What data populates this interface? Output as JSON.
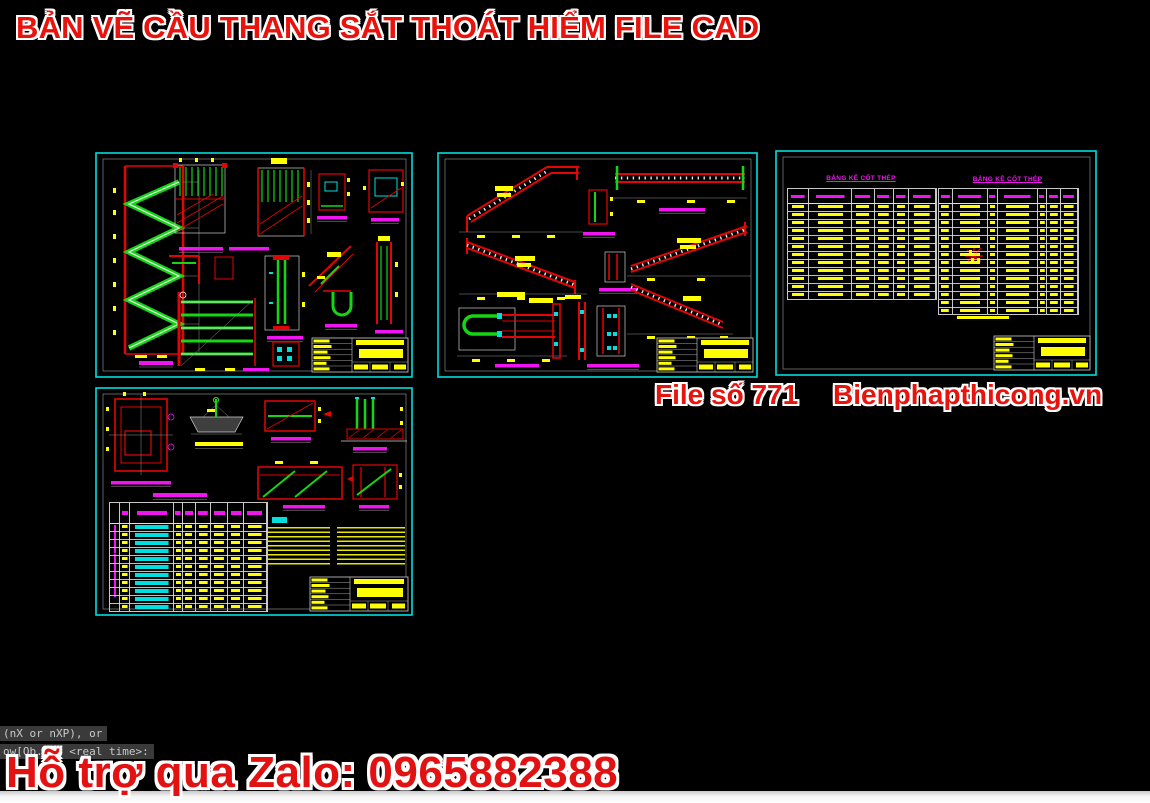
{
  "header": {
    "title": "BẢN VẼ CẦU THANG SẮT THOÁT HIỂM FILE CAD"
  },
  "watermark": {
    "file_label": "File số 771",
    "website": "Bienphapthicong.vn"
  },
  "support_banner": {
    "text": "Hỗ trợ qua Zalo: 0965882388"
  },
  "command_line": {
    "line1": "(nX or nXP), or",
    "line2": "ow[Ob...] <real time>:"
  },
  "sheets": {
    "schedule": {
      "table1_title": "BẢNG KÊ CỐT THÉP",
      "table2_title": "BẢNG KÊ CỐT THÉP"
    }
  },
  "colors": {
    "banner_red": "#e31212",
    "cad_red": "#e30505",
    "cad_green": "#15d615",
    "cad_cyan": "#00dede",
    "cad_yellow": "#ffff00",
    "cad_magenta": "#f014f0",
    "sheet_border": "#00dede"
  }
}
